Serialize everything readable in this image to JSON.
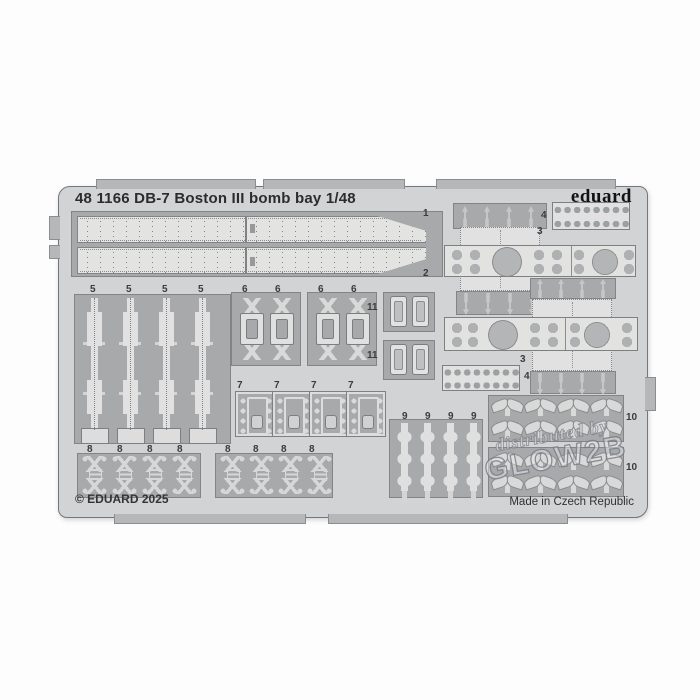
{
  "photo": {
    "sheet_title": "48 1166 DB-7 Boston III bomb bay 1/48",
    "brand_logo": "eduard",
    "copyright": "© EDUARD 2025",
    "made_in": "Made in Czech Republic",
    "watermark": {
      "line1": "distributed by",
      "line2": "GLOW2B"
    },
    "part_numbers": {
      "n1": "1",
      "n2": "2",
      "n3": "3",
      "n4": "4",
      "n5": "5",
      "n6": "6",
      "n7": "7",
      "n8": "8",
      "n9": "9",
      "n10": "10",
      "n11": "11"
    },
    "colors": {
      "background": "#ffffff",
      "sheet_metal": "#d2d3d5",
      "panel_dark": "#a7a9ab",
      "part_light": "#e3e4e3",
      "outline": "#7b7d7f",
      "brand_text": "#131315",
      "label_text": "#3a3b3d"
    }
  }
}
